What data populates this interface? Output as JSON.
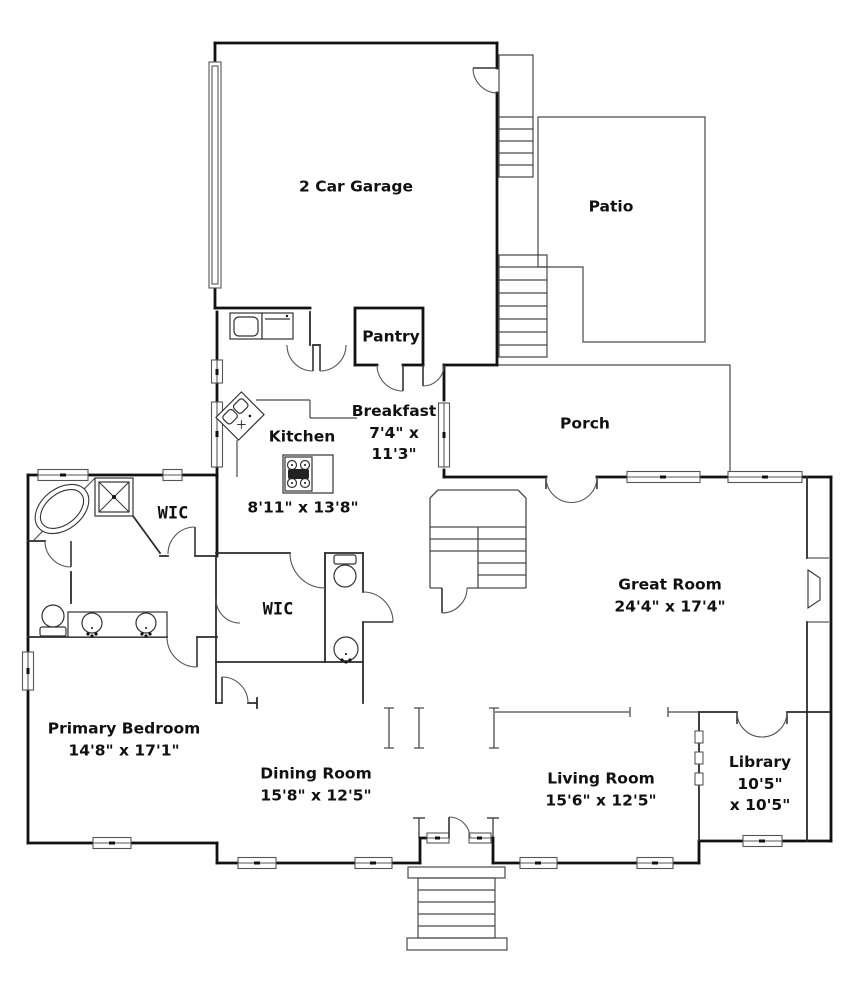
{
  "plan": {
    "type": "single-family residence first-floor plan",
    "colors": {
      "background": "#ffffff",
      "exterior_wall": "#111111",
      "interior_wall": "#2b2b2b",
      "thin_line": "#4a4a4a",
      "text": "#111111"
    },
    "rooms": {
      "garage": {
        "name": "2 Car Garage"
      },
      "patio": {
        "name": "Patio"
      },
      "pantry": {
        "name": "Pantry"
      },
      "breakfast": {
        "name": "Breakfast",
        "dim1": "7'4\" x",
        "dim2": "11'3\""
      },
      "porch": {
        "name": "Porch"
      },
      "kitchen": {
        "name": "Kitchen",
        "dims": "8'11\" x 13'8\""
      },
      "wic1": {
        "name": "WIC"
      },
      "wic2": {
        "name": "WIC"
      },
      "great_room": {
        "name": "Great Room",
        "dims": "24'4\" x 17'4\""
      },
      "primary_bedroom": {
        "name": "Primary Bedroom",
        "dims": "14'8\" x 17'1\""
      },
      "dining_room": {
        "name": "Dining Room",
        "dims": "15'8\" x 12'5\""
      },
      "living_room": {
        "name": "Living Room",
        "dims": "15'6\" x 12'5\""
      },
      "library": {
        "name": "Library",
        "dim1": "10'5\"",
        "dim2": "x 10'5\""
      }
    },
    "fixtures": [
      "bathtub-icon",
      "shower-icon",
      "toilet-icon",
      "double-vanity-icon",
      "pedestal-sink-icon",
      "corner-sink-icon",
      "cooktop-island-icon",
      "washer-icon",
      "dryer-icon",
      "fireplace-icon",
      "garage-door-icon",
      "french-doors-icon",
      "front-door-icon",
      "stairs-icon",
      "window-icon"
    ]
  }
}
